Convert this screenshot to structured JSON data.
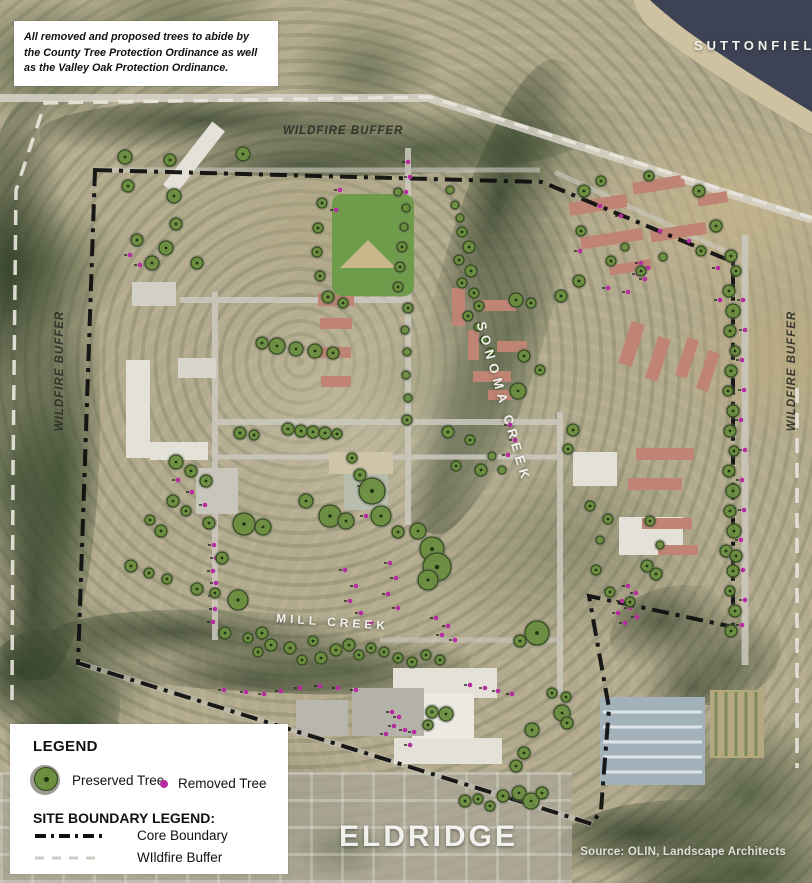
{
  "note_box": {
    "text": "All removed and proposed trees to abide by the County Tree Protection Ordinance as well as the Valley Oak Protection Ordinance."
  },
  "map_labels": {
    "suttonfield": "SUTTONFIELD",
    "eldridge": "ELDRIDGE",
    "wildfire_buffer_top": "WILDFIRE BUFFER",
    "wildfire_buffer_left": "WILDFIRE BUFFER",
    "wildfire_buffer_right": "WILDFIRE BUFFER",
    "sonoma_creek": "SONOMA CREEK",
    "mill_creek": "MILL CREEK"
  },
  "source": {
    "text": "Source: OLIN, Landscape Architects"
  },
  "legend": {
    "title": "LEGEND",
    "preserved_label": "Preserved Tree",
    "removed_label": "Removed Tree",
    "boundary_title": "SITE BOUNDARY LEGEND:",
    "core_label": "Core Boundary",
    "buffer_label": "WIldfire Buffer"
  },
  "colors": {
    "preserved_fill": "#6b8e3f",
    "preserved_stroke": "#2e4618",
    "removed": "#b92ba1",
    "core_boundary": "#101010",
    "wildfire_buffer_line": "#e8e5dc",
    "lake": "#3d4354"
  },
  "map": {
    "preserved_trees": [
      [
        125,
        157,
        7
      ],
      [
        128,
        186,
        6
      ],
      [
        137,
        240,
        6
      ],
      [
        170,
        160,
        6
      ],
      [
        174,
        196,
        7
      ],
      [
        176,
        224,
        6
      ],
      [
        166,
        248,
        7
      ],
      [
        152,
        263,
        7
      ],
      [
        197,
        263,
        6
      ],
      [
        243,
        154,
        7
      ],
      [
        322,
        203,
        5
      ],
      [
        318,
        228,
        5
      ],
      [
        317,
        252,
        5
      ],
      [
        320,
        276,
        5
      ],
      [
        328,
        297,
        6
      ],
      [
        343,
        303,
        5
      ],
      [
        398,
        192,
        4
      ],
      [
        406,
        208,
        4
      ],
      [
        404,
        227,
        4
      ],
      [
        402,
        247,
        5
      ],
      [
        400,
        267,
        5
      ],
      [
        398,
        287,
        5
      ],
      [
        408,
        308,
        5
      ],
      [
        405,
        330,
        4
      ],
      [
        407,
        352,
        4
      ],
      [
        406,
        375,
        4
      ],
      [
        408,
        398,
        4
      ],
      [
        407,
        420,
        5
      ],
      [
        450,
        190,
        4
      ],
      [
        455,
        205,
        4
      ],
      [
        460,
        218,
        4
      ],
      [
        462,
        232,
        5
      ],
      [
        469,
        247,
        6
      ],
      [
        459,
        260,
        5
      ],
      [
        471,
        271,
        6
      ],
      [
        462,
        283,
        5
      ],
      [
        474,
        293,
        5
      ],
      [
        479,
        306,
        5
      ],
      [
        468,
        316,
        5
      ],
      [
        478,
        327,
        4
      ],
      [
        484,
        340,
        4
      ],
      [
        490,
        352,
        4
      ],
      [
        516,
        300,
        7
      ],
      [
        531,
        303,
        5
      ],
      [
        524,
        356,
        6
      ],
      [
        540,
        370,
        5
      ],
      [
        518,
        391,
        8
      ],
      [
        584,
        191,
        6
      ],
      [
        601,
        181,
        5
      ],
      [
        649,
        176,
        5
      ],
      [
        699,
        191,
        6
      ],
      [
        716,
        226,
        6
      ],
      [
        701,
        251,
        5
      ],
      [
        581,
        231,
        5
      ],
      [
        611,
        261,
        5
      ],
      [
        641,
        271,
        5
      ],
      [
        579,
        281,
        6
      ],
      [
        561,
        296,
        6
      ],
      [
        625,
        247,
        4
      ],
      [
        663,
        257,
        4
      ],
      [
        731,
        256,
        6
      ],
      [
        736,
        271,
        5
      ],
      [
        729,
        291,
        6
      ],
      [
        733,
        311,
        7
      ],
      [
        730,
        331,
        6
      ],
      [
        735,
        351,
        5
      ],
      [
        731,
        371,
        6
      ],
      [
        728,
        391,
        5
      ],
      [
        733,
        411,
        6
      ],
      [
        730,
        431,
        6
      ],
      [
        734,
        451,
        5
      ],
      [
        729,
        471,
        6
      ],
      [
        733,
        491,
        7
      ],
      [
        730,
        511,
        6
      ],
      [
        734,
        531,
        7
      ],
      [
        726,
        551,
        6
      ],
      [
        736,
        556,
        6
      ],
      [
        733,
        571,
        6
      ],
      [
        730,
        591,
        5
      ],
      [
        735,
        611,
        6
      ],
      [
        731,
        631,
        6
      ],
      [
        573,
        430,
        6
      ],
      [
        568,
        449,
        5
      ],
      [
        590,
        506,
        5
      ],
      [
        608,
        519,
        5
      ],
      [
        650,
        521,
        5
      ],
      [
        660,
        545,
        4
      ],
      [
        600,
        540,
        4
      ],
      [
        262,
        343,
        6
      ],
      [
        277,
        346,
        8
      ],
      [
        296,
        349,
        7
      ],
      [
        315,
        351,
        7
      ],
      [
        333,
        353,
        6
      ],
      [
        240,
        433,
        6
      ],
      [
        254,
        435,
        5
      ],
      [
        288,
        429,
        6
      ],
      [
        301,
        431,
        6
      ],
      [
        313,
        432,
        6
      ],
      [
        325,
        433,
        6
      ],
      [
        337,
        434,
        5
      ],
      [
        352,
        458,
        5
      ],
      [
        360,
        475,
        6
      ],
      [
        372,
        491,
        13
      ],
      [
        381,
        516,
        10
      ],
      [
        330,
        516,
        11
      ],
      [
        346,
        521,
        8
      ],
      [
        306,
        501,
        7
      ],
      [
        398,
        532,
        6
      ],
      [
        418,
        531,
        8
      ],
      [
        432,
        549,
        12
      ],
      [
        437,
        567,
        14
      ],
      [
        428,
        580,
        10
      ],
      [
        244,
        524,
        11
      ],
      [
        263,
        527,
        8
      ],
      [
        222,
        558,
        6
      ],
      [
        238,
        600,
        10
      ],
      [
        176,
        462,
        7
      ],
      [
        191,
        471,
        6
      ],
      [
        206,
        481,
        6
      ],
      [
        173,
        501,
        6
      ],
      [
        186,
        511,
        5
      ],
      [
        209,
        523,
        6
      ],
      [
        161,
        531,
        6
      ],
      [
        150,
        520,
        5
      ],
      [
        131,
        566,
        6
      ],
      [
        149,
        573,
        5
      ],
      [
        167,
        579,
        5
      ],
      [
        197,
        589,
        6
      ],
      [
        215,
        593,
        5
      ],
      [
        225,
        633,
        6
      ],
      [
        248,
        638,
        5
      ],
      [
        262,
        633,
        6
      ],
      [
        271,
        645,
        6
      ],
      [
        258,
        652,
        5
      ],
      [
        290,
        648,
        6
      ],
      [
        302,
        660,
        5
      ],
      [
        313,
        641,
        5
      ],
      [
        321,
        658,
        6
      ],
      [
        336,
        650,
        6
      ],
      [
        349,
        645,
        6
      ],
      [
        359,
        655,
        5
      ],
      [
        371,
        648,
        5
      ],
      [
        384,
        652,
        5
      ],
      [
        398,
        658,
        5
      ],
      [
        412,
        662,
        5
      ],
      [
        426,
        655,
        5
      ],
      [
        440,
        660,
        5
      ],
      [
        537,
        633,
        12
      ],
      [
        520,
        641,
        6
      ],
      [
        552,
        693,
        5
      ],
      [
        566,
        697,
        5
      ],
      [
        432,
        712,
        6
      ],
      [
        446,
        714,
        7
      ],
      [
        428,
        725,
        5
      ],
      [
        562,
        713,
        8
      ],
      [
        532,
        730,
        7
      ],
      [
        567,
        723,
        6
      ],
      [
        524,
        753,
        6
      ],
      [
        516,
        766,
        6
      ],
      [
        519,
        793,
        7
      ],
      [
        531,
        801,
        8
      ],
      [
        542,
        793,
        6
      ],
      [
        503,
        796,
        6
      ],
      [
        465,
        801,
        6
      ],
      [
        478,
        799,
        5
      ],
      [
        490,
        806,
        5
      ],
      [
        647,
        566,
        6
      ],
      [
        656,
        574,
        6
      ],
      [
        630,
        602,
        5
      ],
      [
        610,
        592,
        5
      ],
      [
        596,
        570,
        5
      ],
      [
        448,
        432,
        6
      ],
      [
        470,
        440,
        5
      ],
      [
        456,
        466,
        5
      ],
      [
        481,
        470,
        6
      ],
      [
        492,
        456,
        4
      ],
      [
        502,
        470,
        4
      ]
    ],
    "removed_trees": [
      [
        743,
        300
      ],
      [
        745,
        330
      ],
      [
        742,
        360
      ],
      [
        744,
        390
      ],
      [
        741,
        420
      ],
      [
        745,
        450
      ],
      [
        742,
        480
      ],
      [
        744,
        510
      ],
      [
        741,
        540
      ],
      [
        743,
        570
      ],
      [
        745,
        600
      ],
      [
        742,
        625
      ],
      [
        718,
        268
      ],
      [
        720,
        300
      ],
      [
        641,
        263
      ],
      [
        648,
        268
      ],
      [
        638,
        274
      ],
      [
        645,
        279
      ],
      [
        600,
        206
      ],
      [
        621,
        216
      ],
      [
        660,
        231
      ],
      [
        689,
        241
      ],
      [
        580,
        251
      ],
      [
        608,
        288
      ],
      [
        628,
        292
      ],
      [
        214,
        545
      ],
      [
        216,
        558
      ],
      [
        213,
        571
      ],
      [
        216,
        583
      ],
      [
        214,
        596
      ],
      [
        215,
        609
      ],
      [
        213,
        622
      ],
      [
        363,
        486
      ],
      [
        371,
        502
      ],
      [
        366,
        516
      ],
      [
        345,
        570
      ],
      [
        356,
        586
      ],
      [
        350,
        601
      ],
      [
        361,
        613
      ],
      [
        371,
        623
      ],
      [
        390,
        563
      ],
      [
        396,
        578
      ],
      [
        388,
        594
      ],
      [
        398,
        608
      ],
      [
        436,
        618
      ],
      [
        448,
        626
      ],
      [
        442,
        635
      ],
      [
        455,
        640
      ],
      [
        392,
        712
      ],
      [
        399,
        717
      ],
      [
        394,
        726
      ],
      [
        405,
        730
      ],
      [
        414,
        732
      ],
      [
        386,
        734
      ],
      [
        410,
        745
      ],
      [
        224,
        690
      ],
      [
        246,
        692
      ],
      [
        264,
        694
      ],
      [
        281,
        691
      ],
      [
        300,
        688
      ],
      [
        320,
        686
      ],
      [
        338,
        688
      ],
      [
        356,
        690
      ],
      [
        408,
        162
      ],
      [
        410,
        177
      ],
      [
        406,
        192
      ],
      [
        340,
        190
      ],
      [
        336,
        210
      ],
      [
        510,
        425
      ],
      [
        515,
        440
      ],
      [
        508,
        455
      ],
      [
        610,
        590
      ],
      [
        628,
        586
      ],
      [
        636,
        593
      ],
      [
        622,
        601
      ],
      [
        630,
        608
      ],
      [
        618,
        613
      ],
      [
        637,
        617
      ],
      [
        625,
        623
      ],
      [
        470,
        685
      ],
      [
        485,
        688
      ],
      [
        498,
        691
      ],
      [
        512,
        694
      ],
      [
        178,
        480
      ],
      [
        192,
        492
      ],
      [
        205,
        505
      ],
      [
        130,
        255
      ],
      [
        140,
        265
      ]
    ]
  }
}
